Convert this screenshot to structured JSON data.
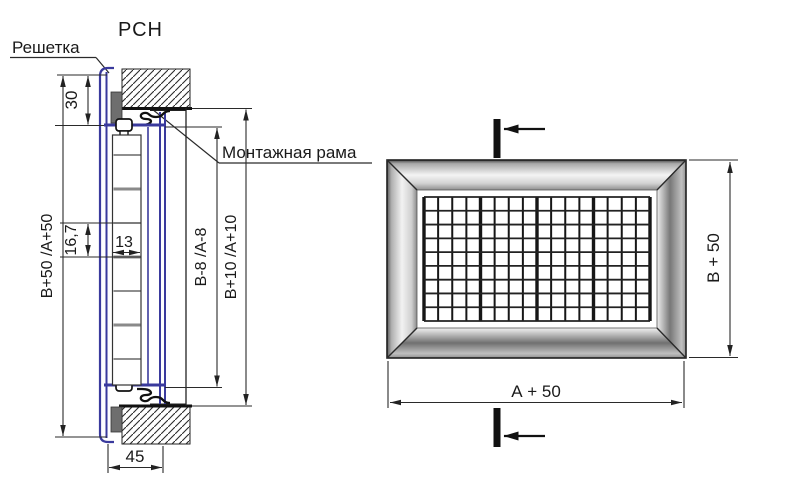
{
  "title": "РСН",
  "callouts": {
    "grille": "Решетка",
    "mounting_frame": "Монтажная рама"
  },
  "section_view": {
    "dim_overall_height": "В+50 /А+50",
    "dim_top_margin": "30",
    "dim_blade_pitch": "16,7",
    "dim_blade_width": "13",
    "dim_inner_size": "В-8 /А-8",
    "dim_frame_size": "В+10 /А+10",
    "dim_depth": "45"
  },
  "front_view": {
    "dim_height": "В + 50",
    "dim_width": "А + 50"
  },
  "colors": {
    "profile_blue": "#3a3a9d",
    "line_dark": "#1c1c1c",
    "gasket_gray": "#6e6e6e"
  }
}
